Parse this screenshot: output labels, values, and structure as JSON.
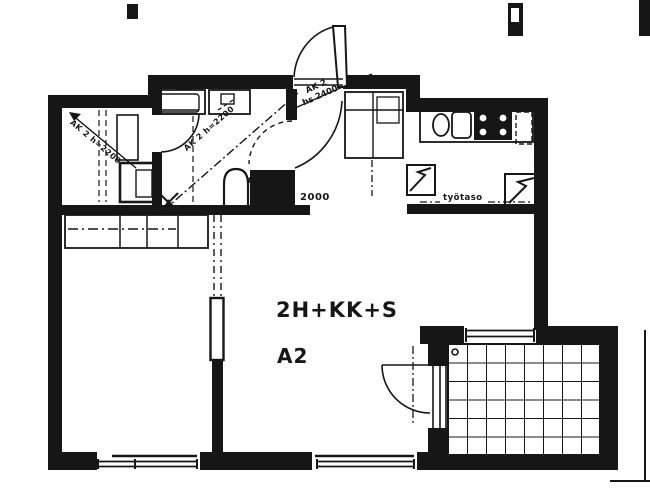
{
  "colors": {
    "ink": "#161616",
    "paper": "#ffffff"
  },
  "plan": {
    "type_label": "2H+KK+S",
    "unit_label": "A2",
    "annotations": {
      "hall_partition_height": "hs 2000",
      "entry_ak": "AK 2",
      "entry_height": "hs 2400",
      "bathroom_ceiling": "AK 2 h=2200",
      "sauna_ceiling": "AK 2 h=2200",
      "kitchen_worktop": "työtaso"
    }
  }
}
